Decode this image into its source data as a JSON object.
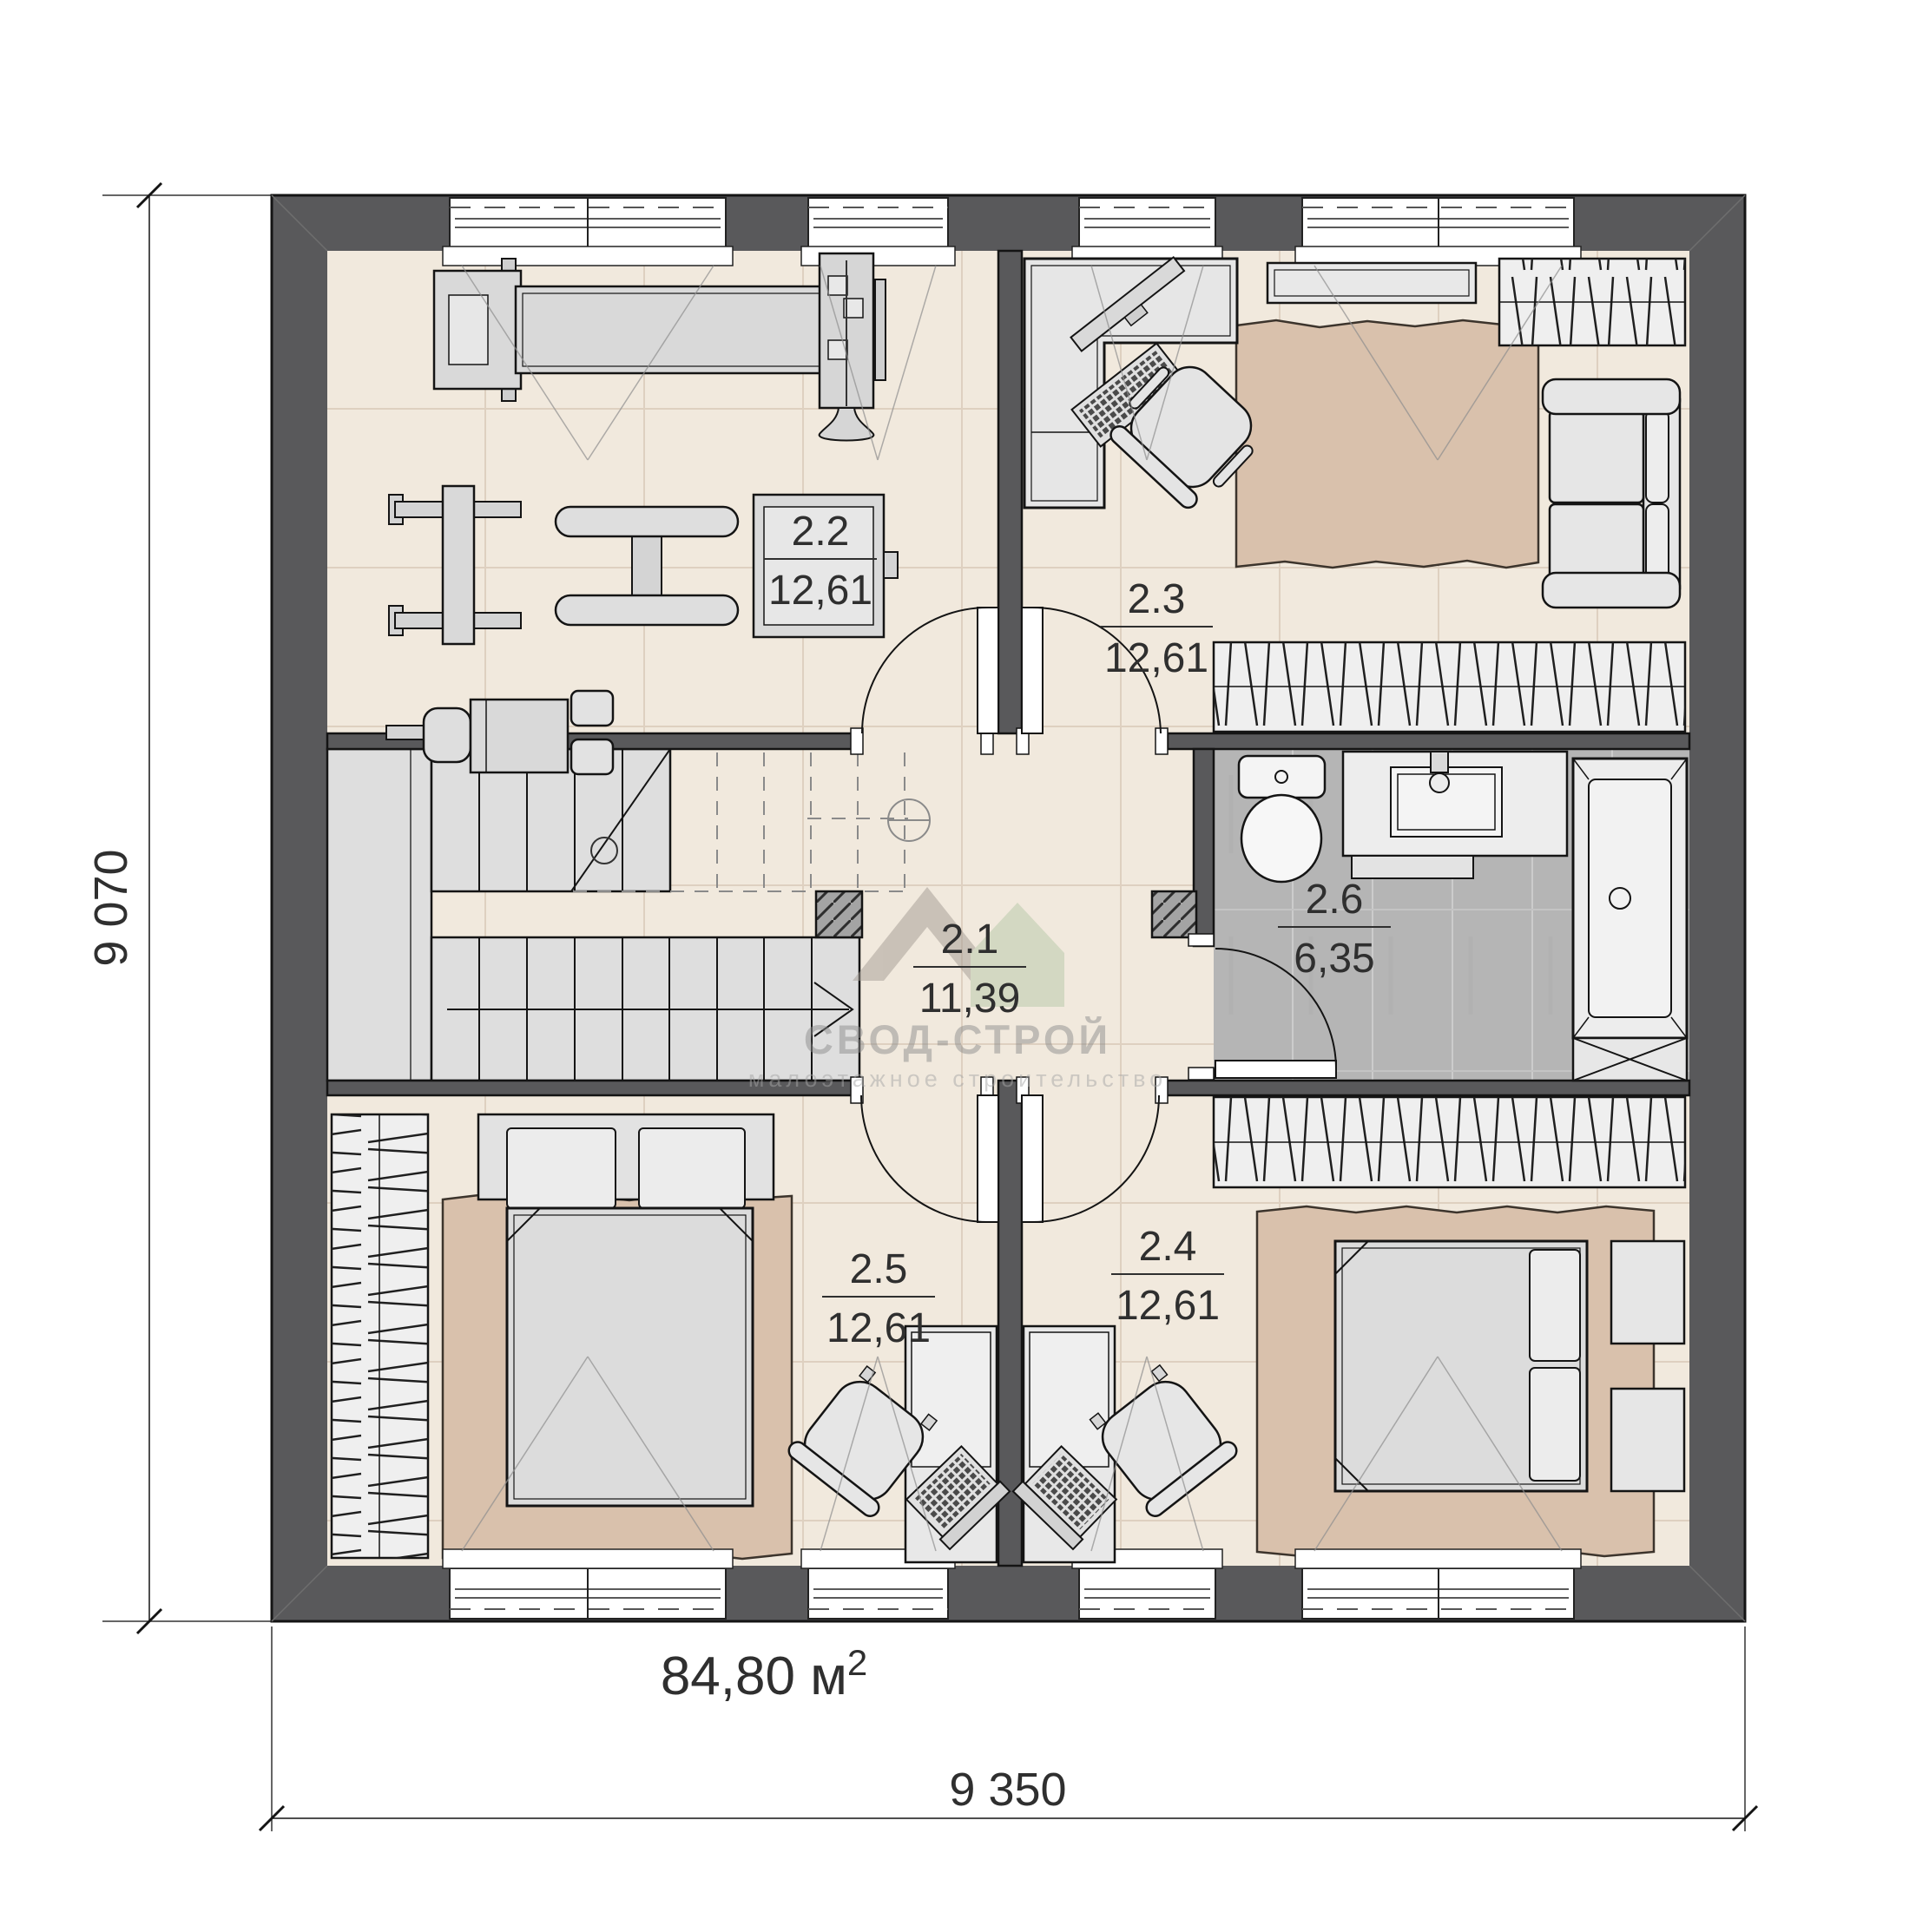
{
  "plan": {
    "floor_area_label": "84,80 м",
    "floor_area_sup": "2",
    "dim_left": "9 070",
    "dim_bottom": "9 350",
    "rooms": [
      {
        "id": "2.1",
        "area": "11,39",
        "name": "hall"
      },
      {
        "id": "2.2",
        "area": "12,61",
        "name": "gym"
      },
      {
        "id": "2.3",
        "area": "12,61",
        "name": "bedroom-top-right"
      },
      {
        "id": "2.4",
        "area": "12,61",
        "name": "bedroom-bottom-right"
      },
      {
        "id": "2.5",
        "area": "12,61",
        "name": "bedroom-bottom-left"
      },
      {
        "id": "2.6",
        "area": "6,35",
        "name": "bathroom"
      }
    ],
    "watermark": {
      "title": "СВОД-СТРОЙ",
      "subtitle": "малоэтажное строительство"
    },
    "colors": {
      "wall": "#59595b",
      "floor": "#f1e9dd",
      "floor_grid": "#ded0c0",
      "rug": "#d9c1ac",
      "furniture": "#e0e0e0",
      "bath_floor": "#b5b5b5",
      "stairs": "#dedede",
      "watermark_green": "#b7c9a8",
      "watermark_gray": "#a39b93"
    }
  }
}
